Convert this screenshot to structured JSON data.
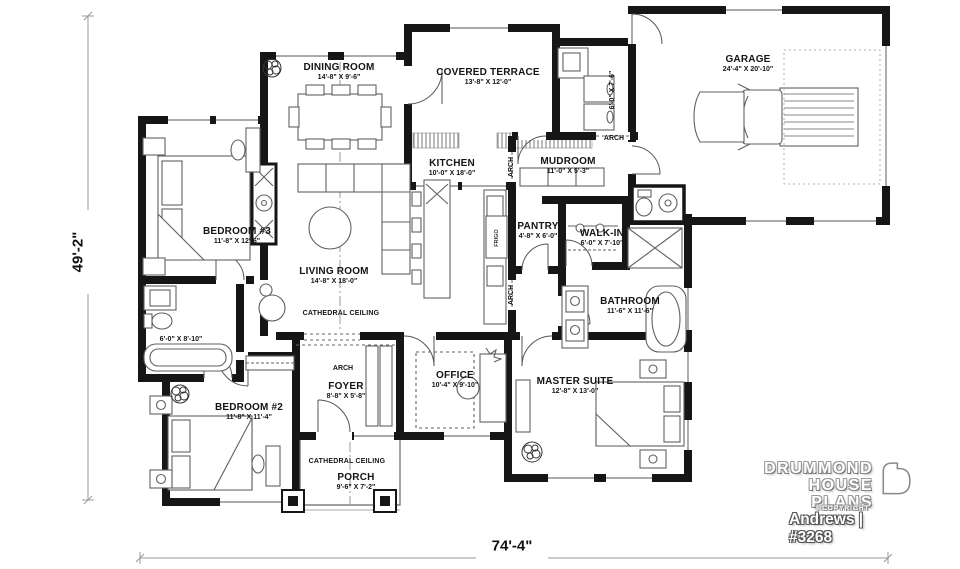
{
  "plan": {
    "sheet": {
      "width_label": "74'-4\"",
      "depth_label": "49'-2\""
    },
    "rooms": [
      {
        "name": "DINING ROOM",
        "dims": "14'-8\" X 9'-6\""
      },
      {
        "name": "COVERED TERRACE",
        "dims": "13'-8\" X 12'-0\""
      },
      {
        "name": "GARAGE",
        "dims": "24'-4\" X 20'-10\""
      },
      {
        "name": "KITCHEN",
        "dims": "10'-0\" X 18'-0\""
      },
      {
        "name": "MUDROOM",
        "dims": "11'-0\" X 5'-3\""
      },
      {
        "name": "BEDROOM #3",
        "dims": "11'-8\" X 12'-6\""
      },
      {
        "name": "LIVING ROOM",
        "dims": "14'-8\" X 18'-0\""
      },
      {
        "name": "PANTRY",
        "dims": "4'-8\" X 6'-0\""
      },
      {
        "name": "WALK-IN",
        "dims": "6'-0\" X 7'-10\""
      },
      {
        "name": "BATHROOM",
        "dims": "11'-6\" X 11'-6\""
      },
      {
        "name": "BEDROOM #2",
        "dims": "11'-8\" X 11'-4\""
      },
      {
        "name": "FOYER",
        "dims": "8'-8\" X 5'-8\""
      },
      {
        "name": "OFFICE",
        "dims": "10'-4\" X 9'-10\""
      },
      {
        "name": "MASTER SUITE",
        "dims": "12'-8\" X 13'-0\""
      },
      {
        "name": "PORCH",
        "dims": "9'-6\" X 7'-2\""
      }
    ],
    "unlabeled_rooms": {
      "laundry_dims": "6'-0\" X 7'-6\"",
      "bath2_dims": "6'-0\" X 8'-10\""
    },
    "annotations": {
      "cathedral_ceiling": "CATHEDRAL CEILING",
      "arch": "ARCH",
      "fridge": "FRIGO"
    },
    "title_block": {
      "brand_line1": "DRUMMOND",
      "brand_line2": "HOUSE PLANS",
      "copyright": "©COPYRIGHT",
      "plan_id": "Andrews | #3268"
    },
    "colors": {
      "wall": "#161616",
      "line": "#666666",
      "dim_line": "#999999"
    }
  }
}
